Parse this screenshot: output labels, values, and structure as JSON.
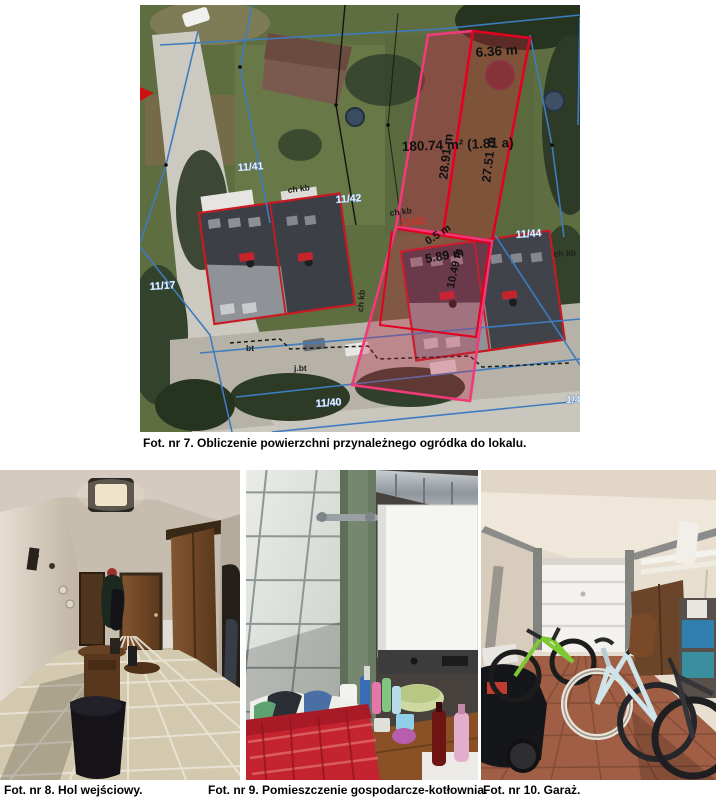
{
  "figure7": {
    "caption": "Fot. nr 7. Obliczenie powierzchni przynależnego ogródka do lokalu.",
    "area_label": "180.74 m² (1.81 a)",
    "dim_top": "6.36 m",
    "dim_left": "28.91 m",
    "dim_right": "27.51 m",
    "dim_a": "0.5 m",
    "dim_b": "5.89 m",
    "dim_c": "10.49 m",
    "parcel_41": "11/41",
    "parcel_42": "11/42",
    "parcel_43": "11/43",
    "parcel_44": "11/44",
    "parcel_40": "11/40",
    "parcel_17": "11/17",
    "parcel_right_clipped": "1/4",
    "ann_chkb_1": "ch kb",
    "ann_chkb_2": "ch kb",
    "ann_chkb_3": "ch kb",
    "ann_chkb_4": "ch kb",
    "ann_jbt": "j.bt",
    "ann_bt": "bt",
    "colors": {
      "highlight_pink": "#f03a7a",
      "highlight_red": "#e30020",
      "parcel_line_blue": "#3e7cc0",
      "building_outline_red": "#c81a22"
    }
  },
  "figure8": {
    "caption": "Fot. nr 8. Hol wejściowy."
  },
  "figure9": {
    "caption": "Fot. nr 9. Pomieszczenie gospodarcze-kotłownia."
  },
  "figure10": {
    "caption": "Fot. nr 10. Garaż."
  }
}
